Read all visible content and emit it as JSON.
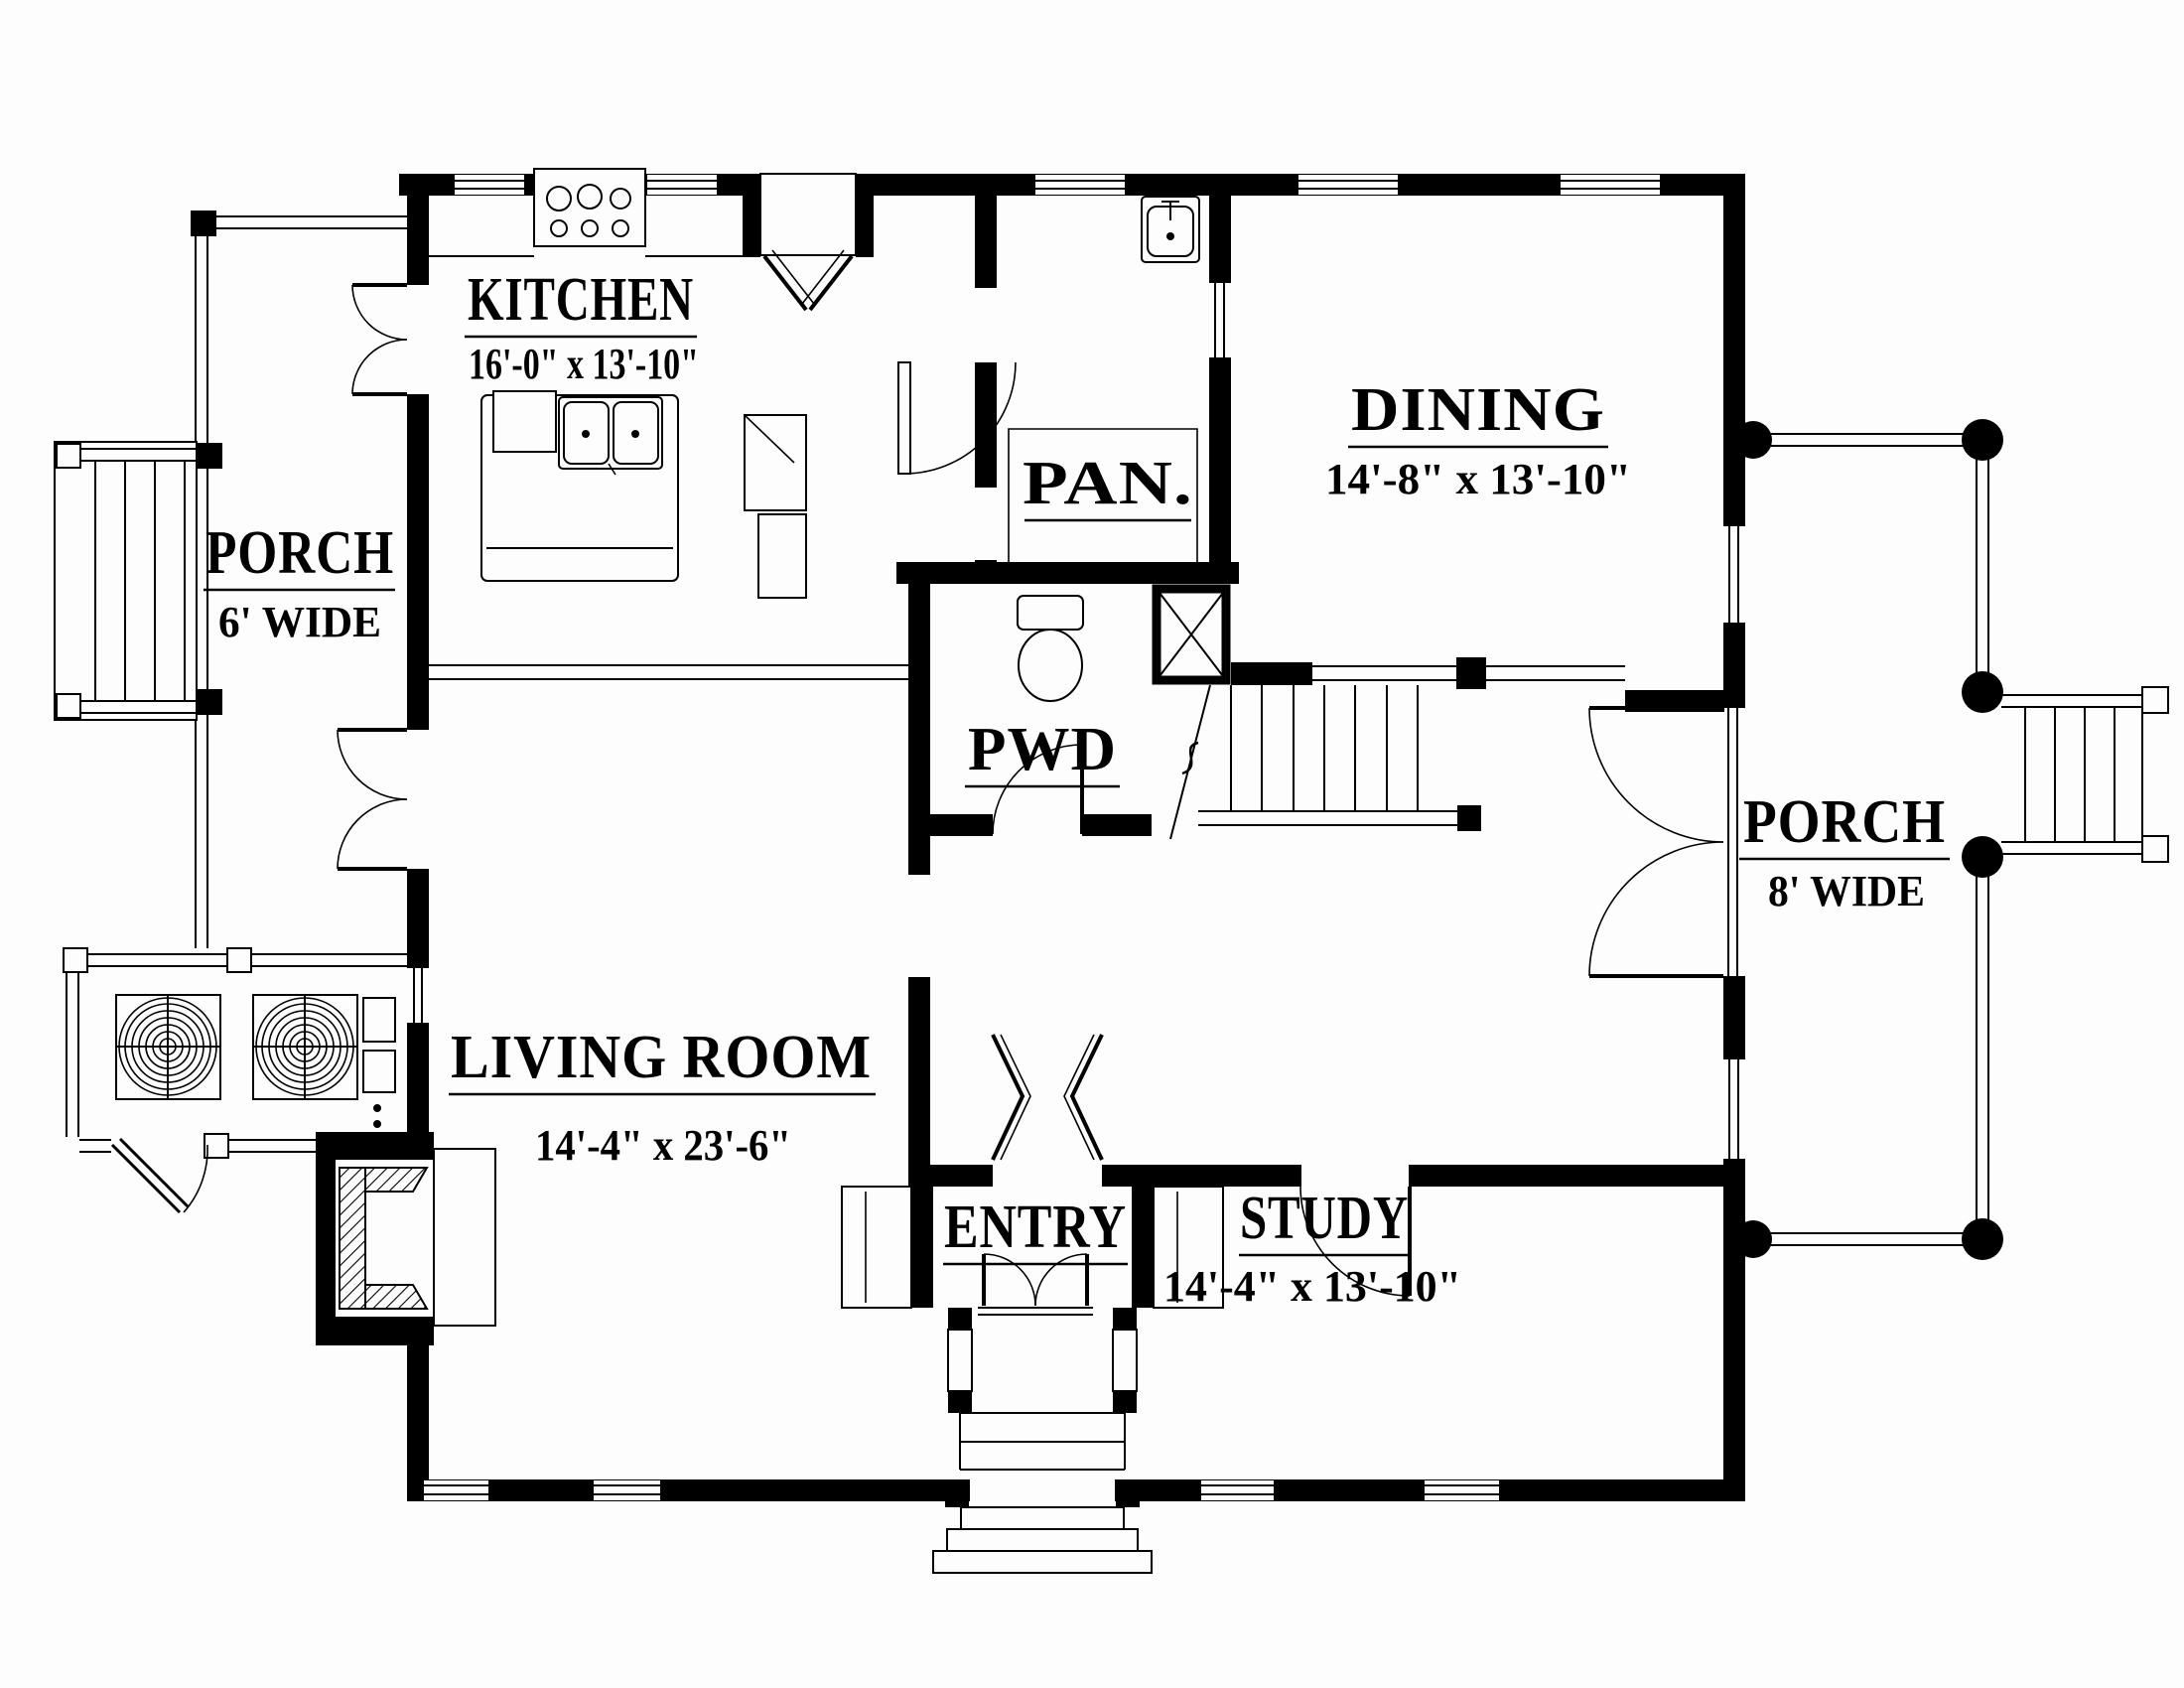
{
  "plan": {
    "colors": {
      "ink": "#000000",
      "paper": "#fdfdfd"
    },
    "rooms": {
      "kitchen": {
        "name": "KITCHEN",
        "dims": "16'-0\" x 13'-10\""
      },
      "dining": {
        "name": "DINING",
        "dims": "14'-8\" x 13'-10\""
      },
      "pantry": {
        "name": "PAN."
      },
      "powder": {
        "name": "PWD"
      },
      "living": {
        "name": "LIVING ROOM",
        "dims": "14'-4\" x 23'-6\""
      },
      "entry": {
        "name": "ENTRY"
      },
      "study": {
        "name": "STUDY",
        "dims": "14'-4\" x 13'-10\""
      },
      "porch_left": {
        "name": "PORCH",
        "dims": "6' WIDE"
      },
      "porch_right": {
        "name": "PORCH",
        "dims": "8' WIDE"
      }
    }
  }
}
